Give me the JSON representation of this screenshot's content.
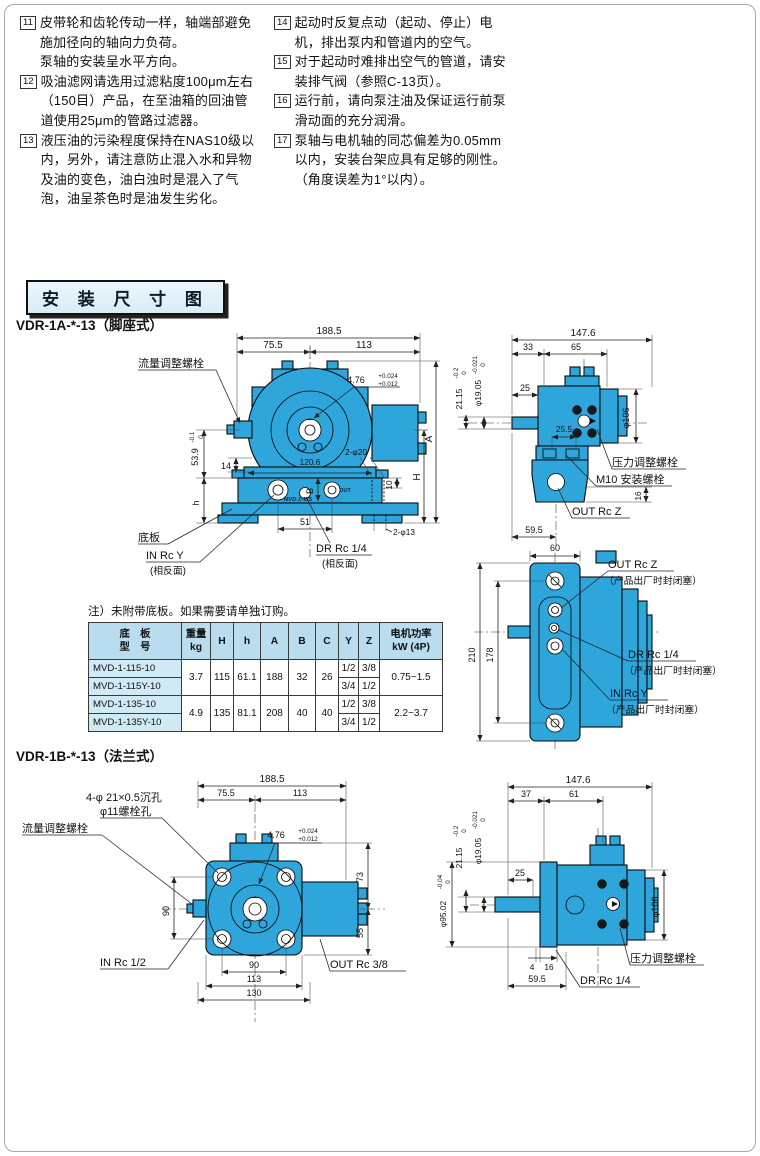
{
  "colors": {
    "pump_blue": "#2ea6dc",
    "table_header_bg": "#b9dcee",
    "model_cell_bg": "#cfe9f5",
    "title_box_bg": "#eaf5fb"
  },
  "notes": {
    "left": [
      {
        "num": "11",
        "text": "皮带轮和齿轮传动一样，轴端部避免施加径向的轴向力负荷。\n泵轴的安装呈水平方向。"
      },
      {
        "num": "12",
        "text": "吸油滤网请选用过滤粘度100μm左右（150目）产品，在至油箱的回油管道使用25μm的管路过滤器。"
      },
      {
        "num": "13",
        "text": "液压油的污染程度保持在NAS10级以内，另外，请注意防止混入水和异物及油的变色，油白浊时是混入了气泡，油呈茶色时是油发生劣化。"
      }
    ],
    "right": [
      {
        "num": "14",
        "text": "起动时反复点动（起动、停止）电机，排出泵内和管道内的空气。"
      },
      {
        "num": "15",
        "text": "对于起动时难排出空气的管道，请安装排气阀（参照C-13页）。"
      },
      {
        "num": "16",
        "text": "运行前，请向泵注油及保证运行前泵滑动面的充分润滑。"
      },
      {
        "num": "17",
        "text": "泵轴与电机轴的同芯偏差为0.05mm以内，安装台架应具有足够的刚性。（角度误差为1°以内）。"
      }
    ]
  },
  "header": {
    "title": "安 装 尺 寸 图"
  },
  "diag_a": {
    "title": "VDR-1A-*-13（脚座式）",
    "front": {
      "d188": "188.5",
      "d75": "75.5",
      "d113": "113",
      "flow_bolt": "流量调整螺栓",
      "t476m": "4.76",
      "t476u": "+0.024",
      "t476l": "+0.012",
      "t539m": "53.9",
      "t539u": "0",
      "t539l": "-0.1",
      "d14": "14",
      "dh": "h",
      "d120": "120.6",
      "d2p20": "2-φ20",
      "d10": "10",
      "dB": "B",
      "dH": "H",
      "dA": "A",
      "base": "底板",
      "in_port": "IN Rc Y",
      "in_note": "(相反面)",
      "d51": "51",
      "dr_port": "DR Rc 1/4",
      "dr_note": "(相反面)",
      "d2p13": "2-φ13",
      "nameplate": "MVD-1-115",
      "out_tag": "OUT"
    },
    "side": {
      "d147": "147.6",
      "d33": "33",
      "d65": "65",
      "d25": "25",
      "d255": "25.5",
      "t21m": "21.15",
      "t21u": "0",
      "t21l": "-0.2",
      "t19m": "φ19.05",
      "t19u": "0",
      "t19l": "-0.021",
      "d106": "φ106",
      "d16": "16",
      "d595": "59.5",
      "press_bolt": "压力调整螺栓",
      "m10_bolt": "M10 安装螺栓",
      "out_port": "OUT Rc Z"
    },
    "bottom": {
      "d60": "60",
      "d210": "210",
      "d178": "178",
      "out_port": "OUT Rc Z",
      "out_note": "（产品出厂时封闭塞）",
      "dr_port": "DR Rc 1/4",
      "dr_note": "（产品出厂时封闭塞）",
      "in_port": "IN Rc Y",
      "in_note": "（产品出厂时封闭塞）"
    }
  },
  "table": {
    "note": "注）未附带底板。如果需要请单独订购。",
    "headers": {
      "model1": "底　板",
      "model2": "型　号",
      "w1": "重量",
      "w2": "kg",
      "H": "H",
      "h": "h",
      "A": "A",
      "B": "B",
      "C": "C",
      "Y": "Y",
      "Z": "Z",
      "p1": "电机功率",
      "p2": "kW (4P)"
    },
    "rows": [
      {
        "model": "MVD-1-115-10",
        "weight": "3.7",
        "H": "115",
        "h": "61.1",
        "A": "188",
        "B": "32",
        "C": "26",
        "Y": "1/2",
        "Z": "3/8",
        "power": "0.75~1.5"
      },
      {
        "model": "MVD-1-115Y-10",
        "Y": "3/4",
        "Z": "1/2"
      },
      {
        "model": "MVD-1-135-10",
        "weight": "4.9",
        "H": "135",
        "h": "81.1",
        "A": "208",
        "B": "40",
        "C": "40",
        "Y": "1/2",
        "Z": "3/8",
        "power": "2.2~3.7"
      },
      {
        "model": "MVD-1-135Y-10",
        "Y": "3/4",
        "Z": "1/2"
      }
    ]
  },
  "diag_b": {
    "title": "VDR-1B-*-13（法兰式）",
    "front": {
      "hole1": "4-φ 21×0.5沉孔",
      "hole2": "φ11螺栓孔",
      "flow_bolt": "流量调整螺栓",
      "d188": "188.5",
      "d75": "75.5",
      "d113": "113",
      "t476m": "4.76",
      "t476u": "+0.024",
      "t476l": "+0.012",
      "d90side": "90",
      "d73": "73",
      "d55": "55",
      "d90": "90",
      "d113b": "113",
      "d130": "130",
      "in_port": "IN Rc 1/2",
      "out_port": "OUT Rc 3/8"
    },
    "side": {
      "d147": "147.6",
      "d37": "37",
      "d61": "61",
      "d25": "25",
      "t21m": "21.15",
      "t21u": "0",
      "t21l": "-0.2",
      "t19m": "φ19.05",
      "t19u": "0",
      "t19l": "-0.021",
      "t95m": "φ95.02",
      "t95u": "0",
      "t95l": "-0.04",
      "d106": "φ106",
      "d4": "4",
      "d16": "16",
      "d595": "59.5",
      "press_bolt": "压力调整螺栓",
      "dr_port": "DR Rc 1/4"
    }
  }
}
